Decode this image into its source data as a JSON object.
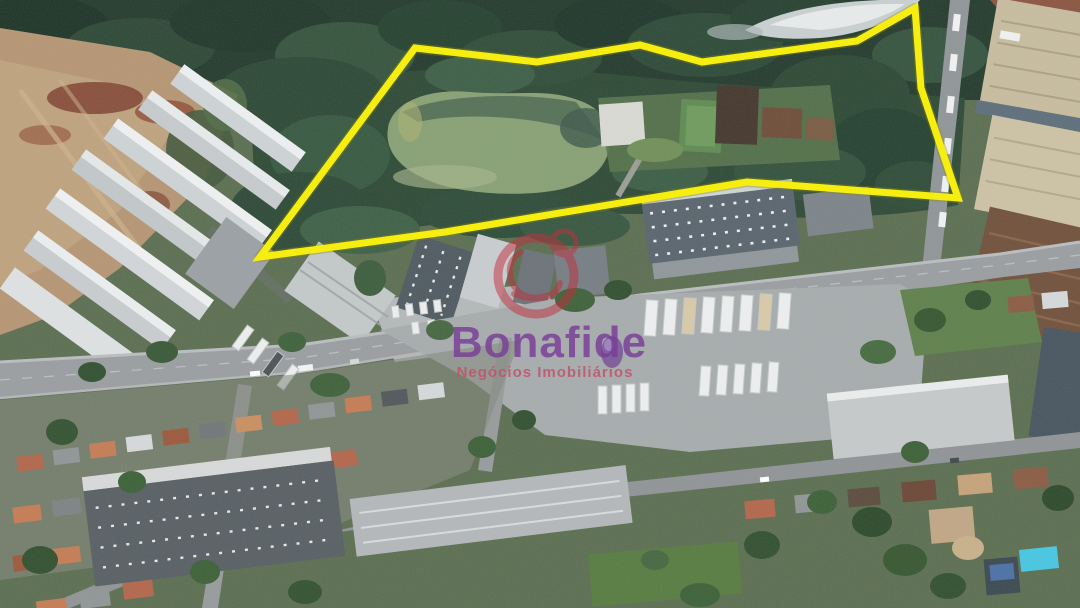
{
  "photo": {
    "description": "Aerial drone photo of a land property for sale, outlined in yellow, with pond, woods, warehouses, avenue and residential blocks",
    "width": 1080,
    "height": 608
  },
  "watermark": {
    "brand": "Bonafide",
    "tagline": "Negócios Imobiliários",
    "brand_color": "#7a3d97",
    "tagline_color": "#c24f68",
    "emblem_color": "#c22f3e"
  },
  "boundary": {
    "color": "#f6ee10",
    "shadow_color": "#8c8a06",
    "points": "415,48 537,62 640,45 702,62 857,41 915,8 921,88 958,198 747,182 445,232 260,257"
  },
  "scene": {
    "forest_color": "#22392c",
    "pond_color": "#87a074",
    "dirt_color": "#b59573",
    "road_color": "#999da0",
    "terracotta_roof_color": "#b2654a",
    "warehouse_roof_color": "#ced3d6",
    "pool_color": "#45c6e3"
  }
}
